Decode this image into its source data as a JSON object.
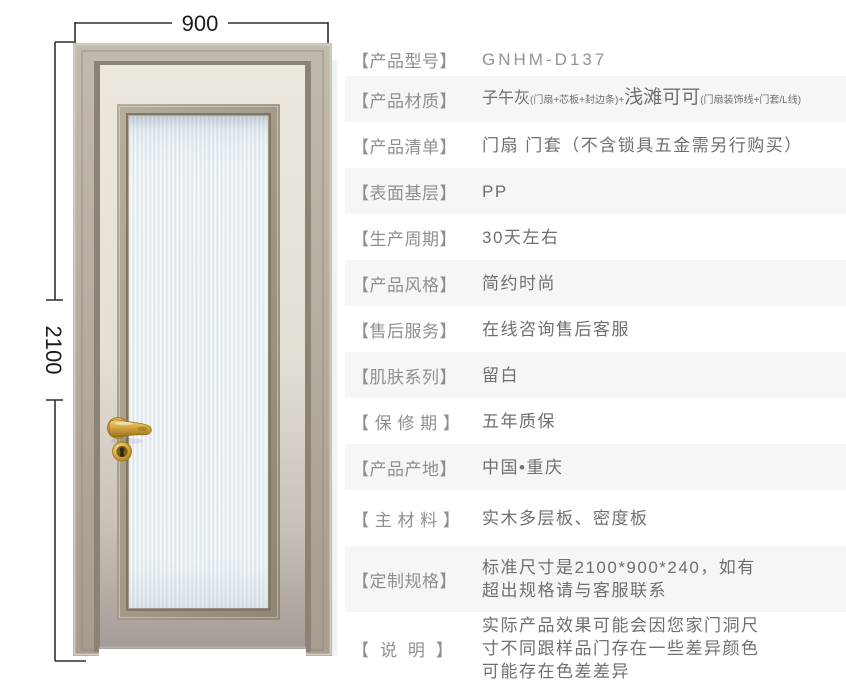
{
  "door": {
    "width_label": "900",
    "height_label": "2100",
    "colors": {
      "casing": "#b2aa9d",
      "leaf_top": "#ece8de",
      "leaf_bottom": "#a49d95",
      "glass_base": "#e7eef3",
      "handle_gold": "#d0a43c",
      "dimension_line": "#2f2f2f"
    }
  },
  "specs": {
    "rows": [
      {
        "label": "【产品型号】",
        "value": "GNHM-D137"
      },
      {
        "label": "【产品材质】",
        "value_main1": "子午灰",
        "value_small1": "(门扇+芯板+封边条)+",
        "value_main2": "浅滩可可",
        "value_small2": "(门扇装饰线+门套/L线)"
      },
      {
        "label": "【产品清单】",
        "value": "门扇 门套（不含锁具五金需另行购买）"
      },
      {
        "label": "【表面基层】",
        "value": "PP"
      },
      {
        "label": "【生产周期】",
        "value": "30天左右"
      },
      {
        "label": "【产品风格】",
        "value": "简约时尚"
      },
      {
        "label": "【售后服务】",
        "value": "在线咨询售后客服"
      },
      {
        "label": "【肌肤系列】",
        "value": "留白"
      },
      {
        "label": "【 保 修 期 】",
        "value": "五年质保"
      },
      {
        "label": "【产品产地】",
        "value": "中国•重庆"
      },
      {
        "label": "【 主 材 料 】",
        "value": "实木多层板、密度板"
      },
      {
        "label": "【定制规格】",
        "value": "标准尺寸是2100*900*240，如有\n超出规格请与客服联系"
      },
      {
        "label": "【  说  明  】",
        "value": "实际产品效果可能会因您家门洞尺\n寸不同跟样品门存在一些差异颜色\n可能存在色差差异"
      }
    ]
  }
}
